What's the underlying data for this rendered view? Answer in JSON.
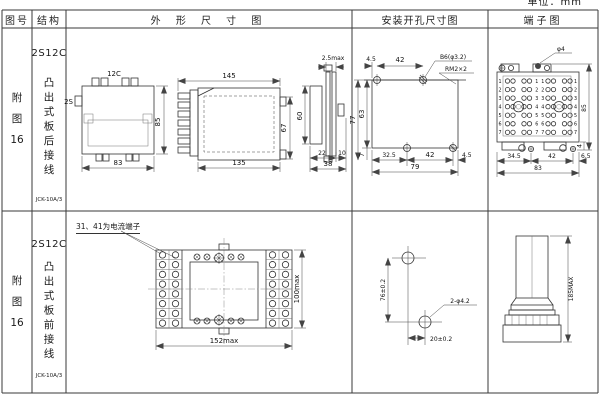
{
  "unit_label": "单位：mm",
  "headers": {
    "fig_no": "图号",
    "structure": "结构",
    "outline": "外 形 尺 寸 图",
    "mounting": "安装开孔尺寸图",
    "terminal": "端子图"
  },
  "rows": [
    {
      "fig_no": "附\n图\n16",
      "model": "2S12C",
      "structure": "凸出式板后接线",
      "type_note": "JCK-10A/3"
    },
    {
      "fig_no": "附\n图\n16",
      "model": "2S12C",
      "structure": "凸出式板前接线",
      "type_note": "JCK-10A/3"
    }
  ],
  "row1": {
    "top_view": {
      "label_top": "12C",
      "label_left": "2S",
      "dim_height": "85",
      "dim_width": "83"
    },
    "side_view": {
      "dim_top": "145",
      "dim_bottom": "135",
      "dim_right": "67"
    },
    "panel_view": {
      "dim_top": "2.5max",
      "dim_left": "60",
      "dim_b1": "22",
      "dim_b2": "10",
      "dim_b3": "38"
    },
    "mounting": {
      "dim_t1": "4.5",
      "dim_t2": "42",
      "hole_label": "B6(φ3.2)",
      "thread_label": "RM2×2",
      "dim_l1": "77",
      "dim_l2": "63",
      "dim_b0": "7",
      "dim_b1": "32.5",
      "dim_b2": "42",
      "dim_b3": "4.5",
      "dim_total": "79"
    },
    "terminal": {
      "screw_label": "φ4",
      "dim_right": "85",
      "dim_r2": "4",
      "dim_b1": "34.5",
      "dim_b2": "42",
      "dim_b3": "6.5",
      "dim_total": "83",
      "row_numbers": [
        "1",
        "2",
        "3",
        "4",
        "5",
        "6",
        "7"
      ]
    }
  },
  "row2": {
    "front_view": {
      "note": "31、41为电流端子",
      "dim_width": "152max",
      "dim_height": "100max"
    },
    "mounting": {
      "dim_v": "76±0.2",
      "dim_h": "20±0.2",
      "hole_label": "2-φ4.2"
    },
    "side_view": {
      "dim_height": "185MAX"
    }
  }
}
